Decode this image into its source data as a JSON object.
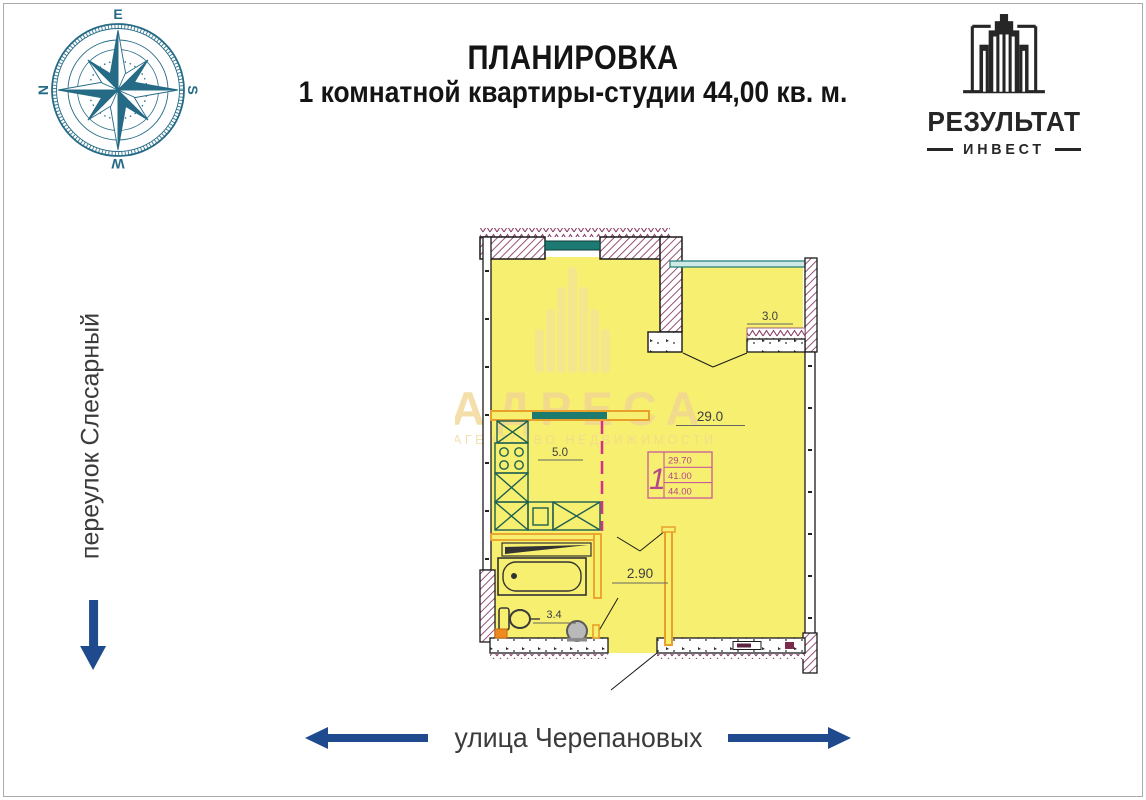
{
  "header": {
    "title_line1": "ПЛАНИРОВКА",
    "title_line2": "1 комнатной квартиры-студии 44,00 кв. м."
  },
  "logo": {
    "icon": "building-icon",
    "name": "РЕЗУЛЬТАТ",
    "subname": "ИНВЕСТ",
    "color": "#262626"
  },
  "compass": {
    "icon": "compass-rose-icon",
    "color": "#256b86",
    "letters": {
      "top": "E",
      "right": "S",
      "bottom": "W",
      "left": "N"
    }
  },
  "streets": {
    "left": {
      "label": "переулок Слесарный",
      "icon": "arrow-down-icon",
      "arrow_color": "#1f4b8e"
    },
    "bottom": {
      "label": "улица Черепановых",
      "icon_left": "arrow-left-icon",
      "icon_right": "arrow-right-icon",
      "arrow_color": "#1f4b8e"
    }
  },
  "floor_plan": {
    "rooms": [
      {
        "name": "loggia",
        "area_label": "3.0"
      },
      {
        "name": "living-room",
        "area_label": "29.0"
      },
      {
        "name": "kitchen",
        "area_label": "5.0"
      },
      {
        "name": "bathroom",
        "area_label": "3.4"
      },
      {
        "name": "hallway",
        "area_label": "2.90"
      }
    ],
    "stamp": {
      "apartment_number": "1",
      "rows": [
        "29.70",
        "41.00",
        "44.00"
      ]
    },
    "colors": {
      "room_fill": "#f7ef6f",
      "wall_hatch": "#8a3d68",
      "window_teal": "#1c7a72",
      "partition_orange": "#e8a02a",
      "kitchen_fixture_green": "#1d5f52",
      "zone_line_magenta": "#d62f8d",
      "stamp_pink": "#b5458c"
    }
  },
  "watermark": {
    "icon": "building-watermark-icon",
    "line1": "АДРЕСА",
    "line2": "АГЕНТСТВО НЕДВИЖИМОСТИ"
  }
}
